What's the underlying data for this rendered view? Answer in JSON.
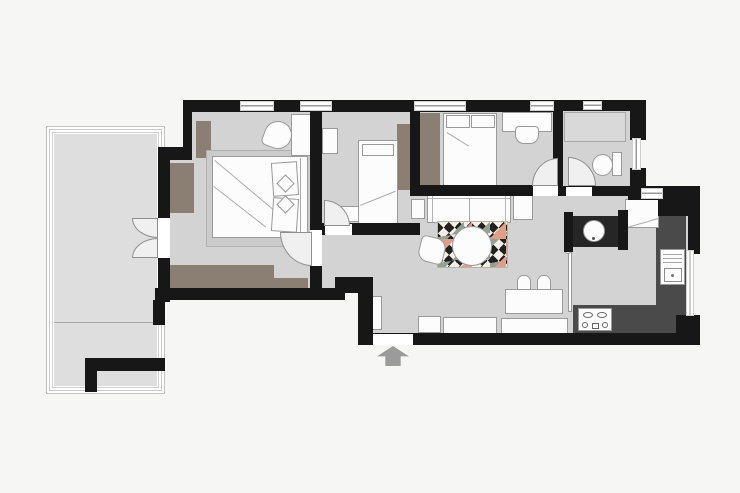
{
  "figure": {
    "type": "floor-plan",
    "description": "Top-down apartment floor plan with balcony, two bedrooms, a small middle room, bathroom, hallway, open living-dining area, kitchen and an entrance arrow at the bottom"
  },
  "colors": {
    "canvas-bg": "#f6f6f5",
    "wall": "#171717",
    "floor": "#d3d3d3",
    "balcony-floor": "#dedede",
    "wardrobe": "#8b7e72",
    "furniture": "#fcfcfc",
    "outline": "#9a9a9a",
    "counter": "#4a4a4a",
    "dark-counter": "#262626",
    "rug-base": "#f4efe9",
    "rug-dark": "#23211f",
    "rug-salmon": "#dfa089",
    "rug-sage": "#93a195",
    "arrow": "#9b9b9b",
    "shower": "#d9d9d9",
    "rug-bedroom": "#cbcbcb"
  },
  "rooms": [
    {
      "name": "balcony"
    },
    {
      "name": "master-bedroom"
    },
    {
      "name": "middle-room"
    },
    {
      "name": "second-bedroom"
    },
    {
      "name": "bathroom"
    },
    {
      "name": "hallway"
    },
    {
      "name": "living-dining"
    },
    {
      "name": "kitchen"
    }
  ],
  "furniture": [
    "double-bed",
    "single-bed",
    "child-bed",
    "wardrobe",
    "bedside-table",
    "armchair",
    "desk",
    "desk-chair",
    "shower",
    "toilet",
    "washbasin-counter",
    "sofa",
    "side-table",
    "cabinet",
    "patterned-rug",
    "round-table",
    "chair",
    "dining-table",
    "dining-chair",
    "sideboard",
    "shoe-cabinet",
    "fridge",
    "kitchen-counter",
    "sink",
    "stove",
    "french-balcony-door",
    "entrance-arrow"
  ]
}
